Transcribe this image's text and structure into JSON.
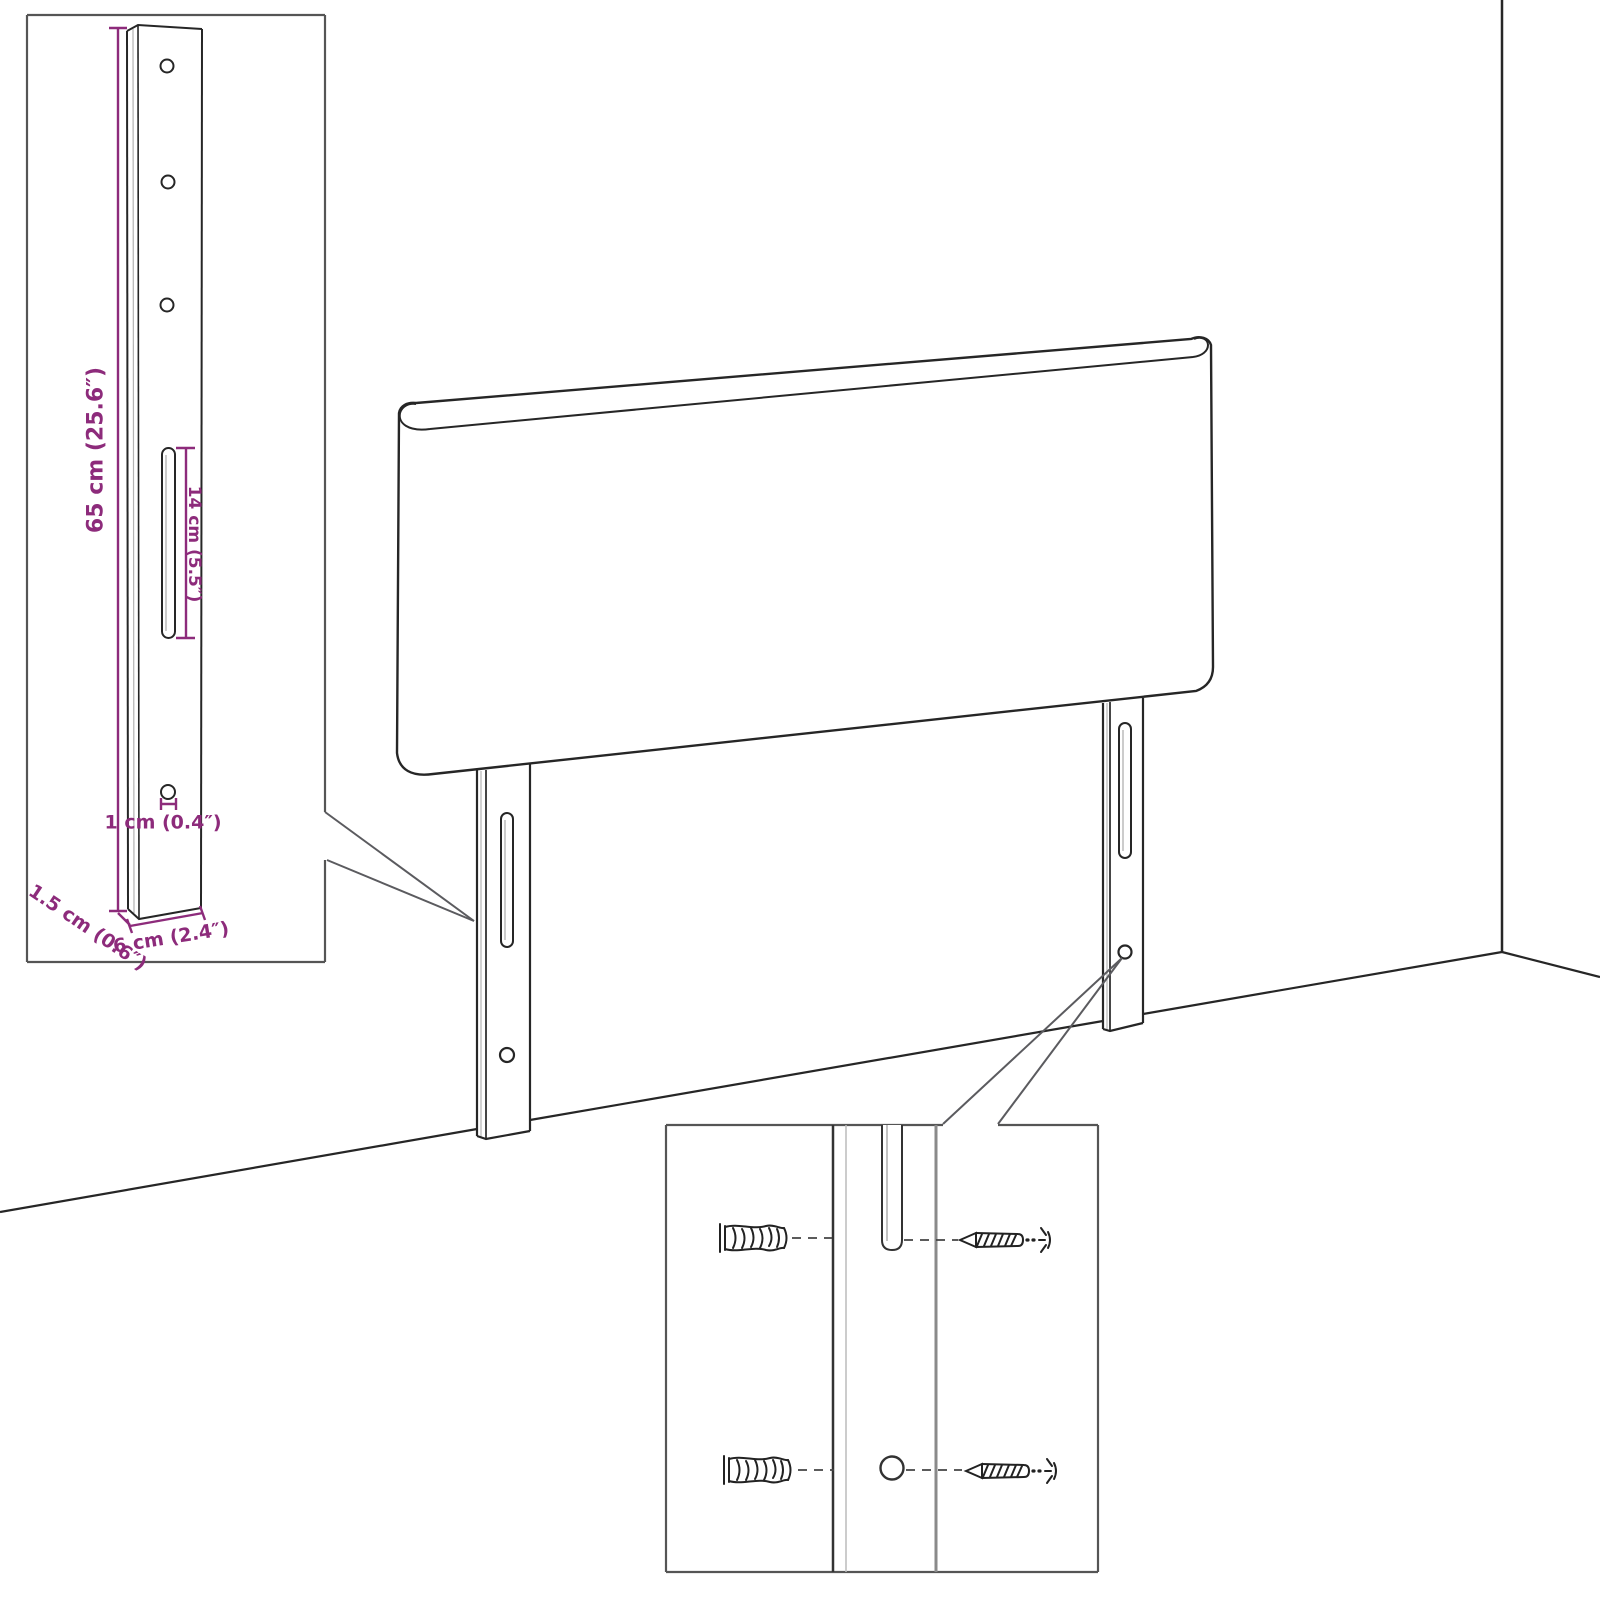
{
  "diagram_type": "furniture-assembly-dimension-diagram",
  "colors": {
    "background": "#ffffff",
    "outline": "#262626",
    "inset_border": "#555555",
    "dimension": "#8d2b7b"
  },
  "scene": {
    "subject": "headboard-with-two-mounting-legs-against-wall-corner"
  },
  "bracket_inset": {
    "dim_height": "65 cm (25.6″)",
    "dim_slot": "14 cm (5.5″)",
    "dim_hole": "1 cm (0.4″)",
    "dim_thickness": "1.5 cm (0.6″)",
    "dim_width": "6 cm (2.4″)"
  },
  "hardware_inset": {
    "icons": {
      "wall_plug": "wall-plug-icon",
      "screw": "screw-icon"
    }
  }
}
